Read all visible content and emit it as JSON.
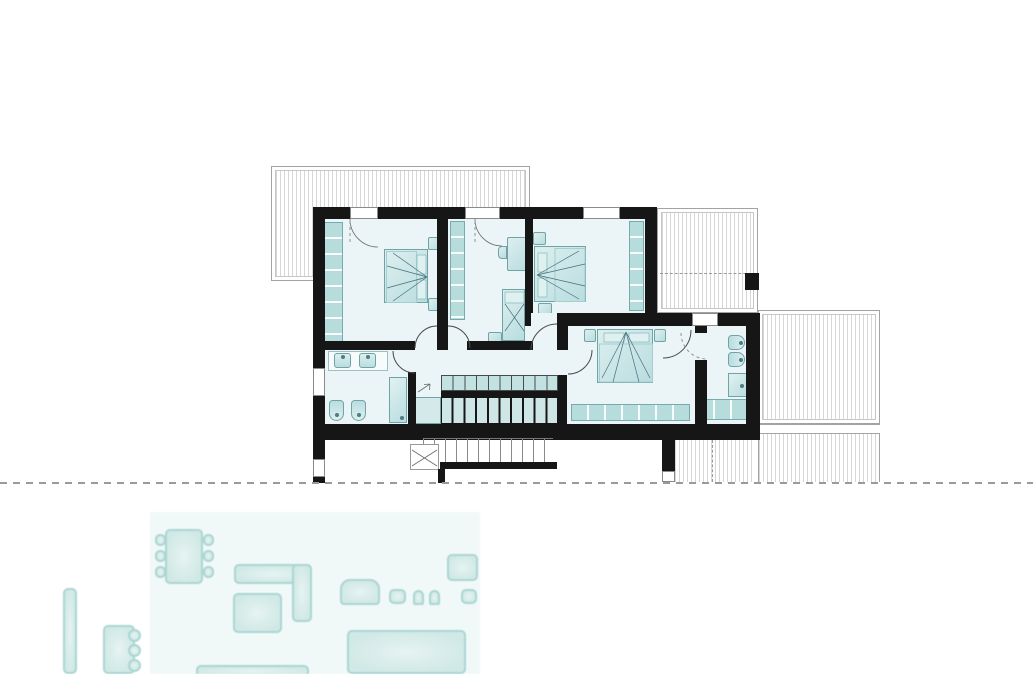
{
  "drawing": {
    "kind": "architectural floor plan",
    "upper_floor": {
      "rooms": [
        "bedroom-1",
        "bedroom-2",
        "bedroom-3",
        "bedroom-4",
        "bathroom-1",
        "bathroom-2",
        "corridor",
        "staircase"
      ],
      "outdoor_areas": [
        "roof-top-left",
        "terrace-top-right",
        "terrace-right",
        "balcony-bottom"
      ],
      "furniture": [
        "double-bed",
        "single-bed-with-desk",
        "double-bed",
        "double-bed",
        "wardrobes",
        "twin-sinks",
        "two-toilets",
        "shower-cabinet",
        "toilet",
        "bidet",
        "shower",
        "bathroom-cabinet"
      ],
      "stairs": {
        "upper_flight_steps": 10,
        "lower_flight_steps": 11,
        "basement_flight_steps": 12
      }
    },
    "ground_floor_partial": {
      "furniture": [
        "dining-table-with-six-chairs",
        "l-shaped-sofa",
        "ottoman",
        "sideboard",
        "desk-with-chairs",
        "kitchen-counter",
        "bar-stools",
        "kitchen-island",
        "tall-cabinet"
      ]
    }
  },
  "colors": {
    "background": "#ffffff",
    "wall": "#161616",
    "floor": "#ebf4f6",
    "furniture_fill": "#b9dde0",
    "furniture_light": "#ddefef",
    "furniture_border": "#6fa3a6",
    "wardrobe": "#b7dcdc",
    "hatch": "#d6d6d6",
    "hatch_border": "#a3a3a3",
    "dash": "#9a9a9a",
    "arc": "#4a4a4a",
    "step_fill": "#c2e1e1",
    "basement_line": "#8a8a8a",
    "ground_fill": "#cfe8e5",
    "ground_border": "#a6d4d0",
    "ground_bg": "#f1f8f8"
  }
}
